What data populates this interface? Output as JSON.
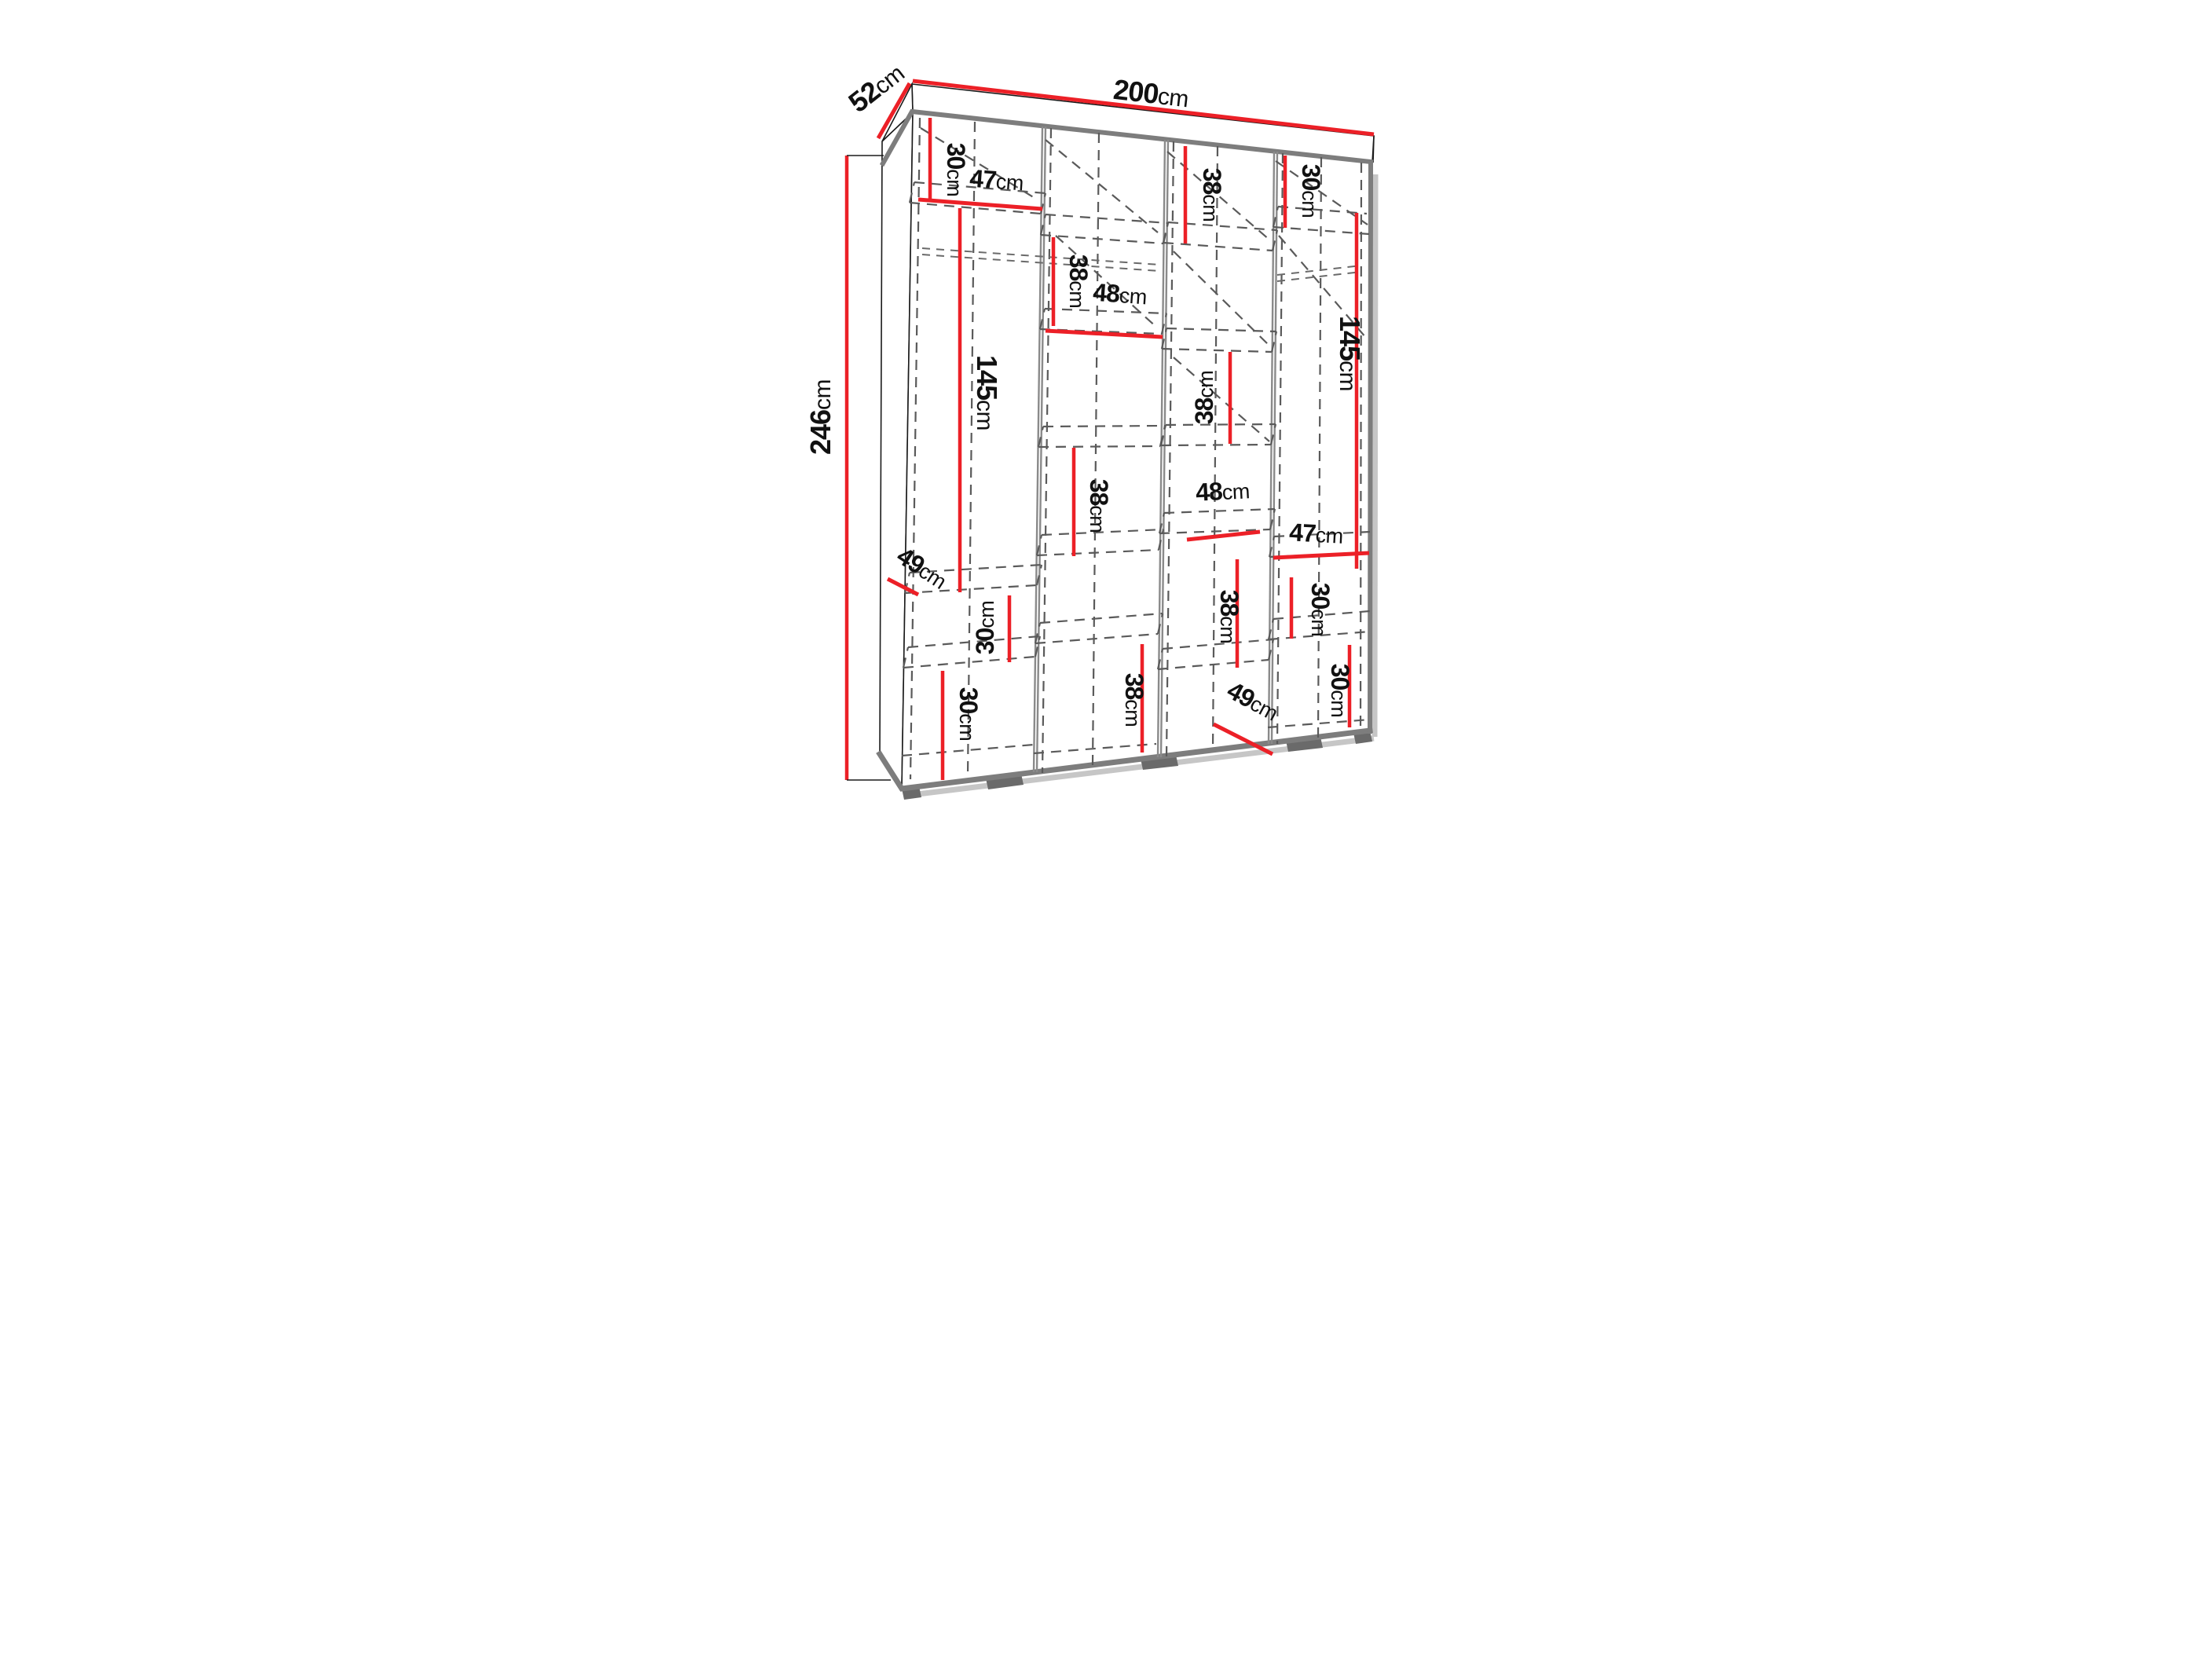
{
  "diagram": {
    "kind": "wardrobe-dimension-drawing",
    "unit": "cm",
    "overall": {
      "width": "200cm",
      "depth": "52cm",
      "height": "246cm"
    },
    "colors": {
      "dimension_line": "#ec2027",
      "structure_gray": "#7d7d7d",
      "dashed_gray": "#5a5a5a",
      "text": "#111111",
      "background": "#ffffff"
    },
    "labels": [
      {
        "id": "depth",
        "value": "52",
        "unit": "cm"
      },
      {
        "id": "width",
        "value": "200",
        "unit": "cm"
      },
      {
        "id": "height",
        "value": "246",
        "unit": "cm"
      },
      {
        "id": "col1-top-30",
        "value": "30",
        "unit": "cm"
      },
      {
        "id": "col1-47",
        "value": "47",
        "unit": "cm"
      },
      {
        "id": "col1-145",
        "value": "145",
        "unit": "cm"
      },
      {
        "id": "col1-49",
        "value": "49",
        "unit": "cm"
      },
      {
        "id": "col1-mid-30",
        "value": "30",
        "unit": "cm"
      },
      {
        "id": "col1-bot-30",
        "value": "30",
        "unit": "cm"
      },
      {
        "id": "col2-top-38",
        "value": "38",
        "unit": "cm"
      },
      {
        "id": "col2-48",
        "value": "48",
        "unit": "cm"
      },
      {
        "id": "col2-mid-38",
        "value": "38",
        "unit": "cm"
      },
      {
        "id": "col2-bot-38",
        "value": "38",
        "unit": "cm"
      },
      {
        "id": "col3-top-38",
        "value": "38",
        "unit": "cm"
      },
      {
        "id": "col3-mid-38",
        "value": "38",
        "unit": "cm"
      },
      {
        "id": "col3-48",
        "value": "48",
        "unit": "cm"
      },
      {
        "id": "col3-low-38",
        "value": "38",
        "unit": "cm"
      },
      {
        "id": "col3-49",
        "value": "49",
        "unit": "cm"
      },
      {
        "id": "col4-top-30",
        "value": "30",
        "unit": "cm"
      },
      {
        "id": "col4-145",
        "value": "145",
        "unit": "cm"
      },
      {
        "id": "col4-47",
        "value": "47",
        "unit": "cm"
      },
      {
        "id": "col4-mid-30",
        "value": "30",
        "unit": "cm"
      },
      {
        "id": "col4-bot-30",
        "value": "30",
        "unit": "cm"
      }
    ]
  }
}
